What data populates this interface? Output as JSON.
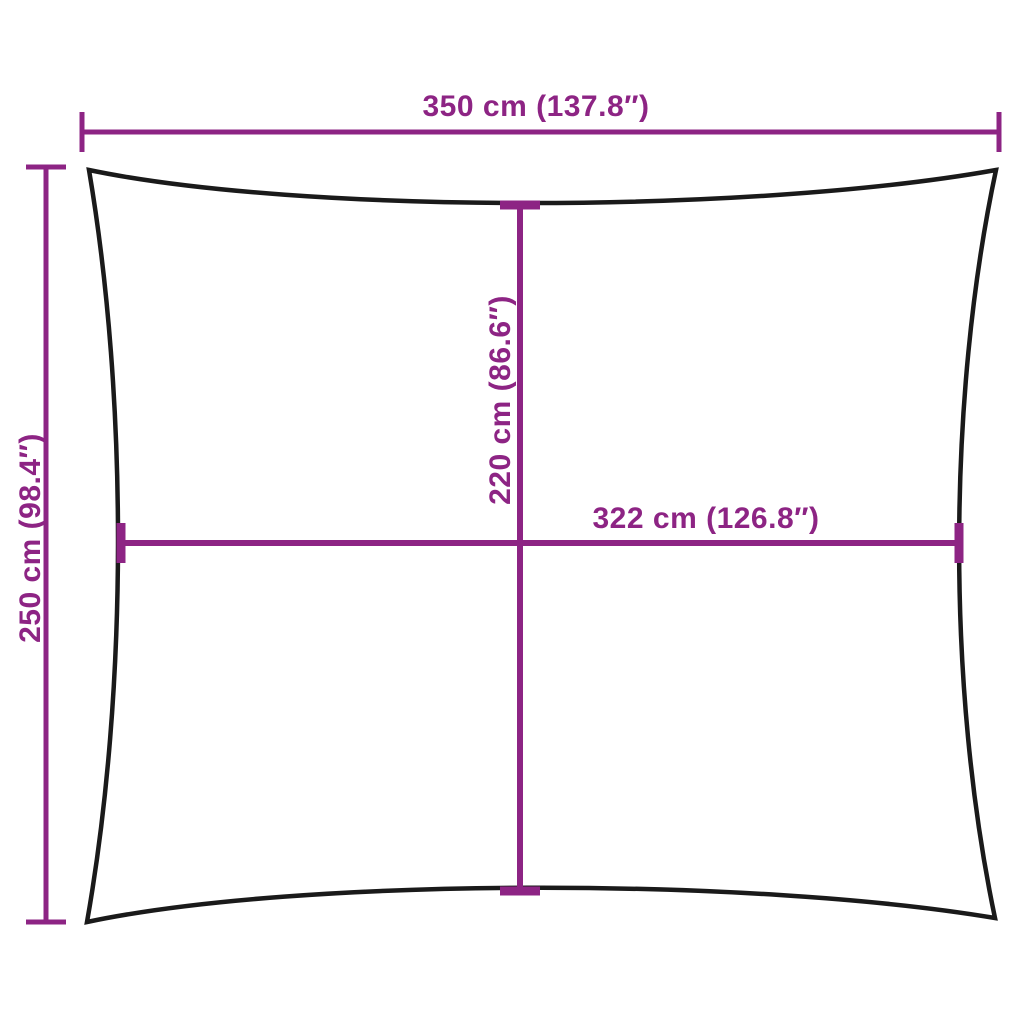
{
  "diagram": {
    "colors": {
      "dimension_lines": "#8D2484",
      "sail_outline": "#1A1A1A",
      "background": "#FFFFFF"
    },
    "dimensions": {
      "width": {
        "label": "350 cm (137.8″)",
        "cm": 350,
        "inches": 137.8
      },
      "height": {
        "label": "250 cm (98.4″)",
        "cm": 250,
        "inches": 98.4
      },
      "inner_height": {
        "label": "220 cm (86.6″)",
        "cm": 220,
        "inches": 86.6
      },
      "inner_width": {
        "label": "322 cm (126.8″)",
        "cm": 322,
        "inches": 126.8
      }
    }
  }
}
